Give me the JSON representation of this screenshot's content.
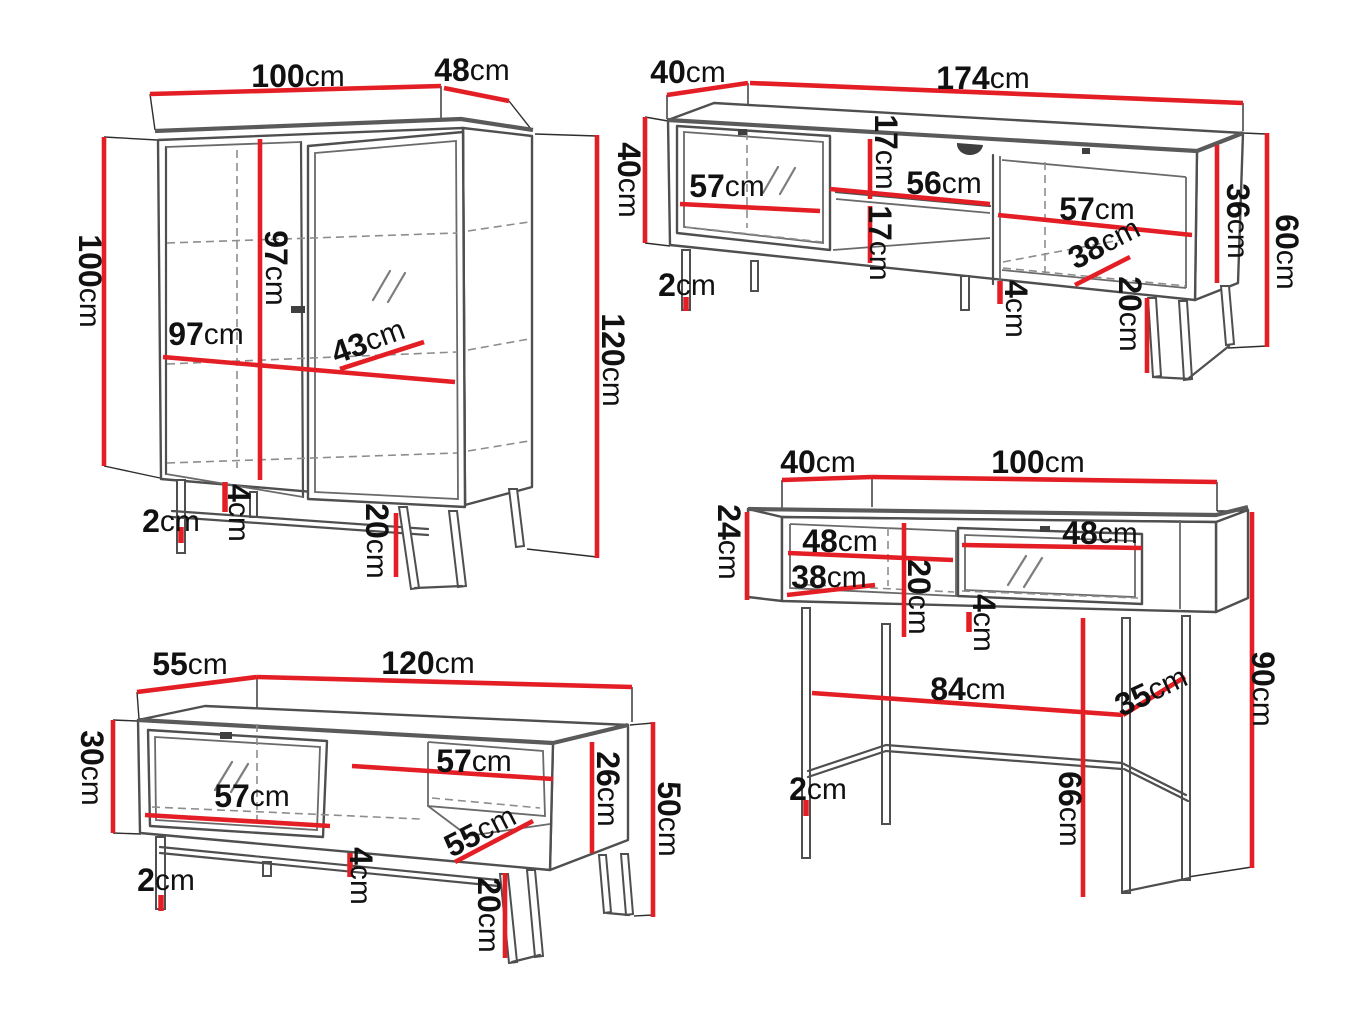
{
  "title": "furniture-dimensions-diagram",
  "colors": {
    "dimension_line": "#e41e25",
    "outline": "#4f4f4f",
    "hidden_line": "#8d8d8d",
    "text": "#111111",
    "background": "#ffffff"
  },
  "unit": "cm",
  "pieces": [
    {
      "name": "display-cabinet",
      "dims": [
        {
          "k": "top-width",
          "v": "100",
          "u": "cm"
        },
        {
          "k": "top-depth",
          "v": "48",
          "u": "cm"
        },
        {
          "k": "left-height",
          "v": "100",
          "u": "cm"
        },
        {
          "k": "interior-height",
          "v": "97",
          "u": "cm"
        },
        {
          "k": "interior-width",
          "v": "97",
          "u": "cm"
        },
        {
          "k": "shelf-width",
          "v": "43",
          "u": "cm"
        },
        {
          "k": "total-height",
          "v": "120",
          "u": "cm"
        },
        {
          "k": "base-gap",
          "v": "4",
          "u": "cm"
        },
        {
          "k": "leg-thickness",
          "v": "2",
          "u": "cm"
        },
        {
          "k": "leg-height",
          "v": "20",
          "u": "cm"
        }
      ]
    },
    {
      "name": "tv-stand",
      "dims": [
        {
          "k": "top-depth",
          "v": "40",
          "u": "cm"
        },
        {
          "k": "width",
          "v": "174",
          "u": "cm"
        },
        {
          "k": "left-height",
          "v": "40",
          "u": "cm"
        },
        {
          "k": "door-width",
          "v": "57",
          "u": "cm"
        },
        {
          "k": "shelf-gap-top",
          "v": "17",
          "u": "cm"
        },
        {
          "k": "shelf-width",
          "v": "56",
          "u": "cm"
        },
        {
          "k": "shelf-gap-bottom",
          "v": "17",
          "u": "cm"
        },
        {
          "k": "right-opening-width",
          "v": "57",
          "u": "cm"
        },
        {
          "k": "right-opening-depth",
          "v": "38",
          "u": "cm"
        },
        {
          "k": "side-height",
          "v": "36",
          "u": "cm"
        },
        {
          "k": "total-height",
          "v": "60",
          "u": "cm"
        },
        {
          "k": "leg-thickness",
          "v": "2",
          "u": "cm"
        },
        {
          "k": "base-gap",
          "v": "4",
          "u": "cm"
        },
        {
          "k": "leg-height",
          "v": "20",
          "u": "cm"
        }
      ]
    },
    {
      "name": "coffee-table",
      "dims": [
        {
          "k": "top-depth",
          "v": "55",
          "u": "cm"
        },
        {
          "k": "width",
          "v": "120",
          "u": "cm"
        },
        {
          "k": "left-height",
          "v": "30",
          "u": "cm"
        },
        {
          "k": "door-width",
          "v": "57",
          "u": "cm"
        },
        {
          "k": "shelf-width",
          "v": "57",
          "u": "cm"
        },
        {
          "k": "inner-height",
          "v": "26",
          "u": "cm"
        },
        {
          "k": "total-height",
          "v": "50",
          "u": "cm"
        },
        {
          "k": "shelf-depth",
          "v": "55",
          "u": "cm"
        },
        {
          "k": "base-gap",
          "v": "4",
          "u": "cm"
        },
        {
          "k": "leg-thickness",
          "v": "2",
          "u": "cm"
        },
        {
          "k": "leg-height",
          "v": "20",
          "u": "cm"
        }
      ]
    },
    {
      "name": "console-desk",
      "dims": [
        {
          "k": "top-depth",
          "v": "40",
          "u": "cm"
        },
        {
          "k": "top-width",
          "v": "100",
          "u": "cm"
        },
        {
          "k": "body-height",
          "v": "24",
          "u": "cm"
        },
        {
          "k": "opening-width",
          "v": "48",
          "u": "cm"
        },
        {
          "k": "opening-depth",
          "v": "38",
          "u": "cm"
        },
        {
          "k": "inner-height",
          "v": "20",
          "u": "cm"
        },
        {
          "k": "drawer-width",
          "v": "48",
          "u": "cm"
        },
        {
          "k": "base-gap",
          "v": "4",
          "u": "cm"
        },
        {
          "k": "stretcher-width",
          "v": "84",
          "u": "cm"
        },
        {
          "k": "stretcher-depth",
          "v": "35",
          "u": "cm"
        },
        {
          "k": "total-height",
          "v": "90",
          "u": "cm"
        },
        {
          "k": "clearance-height",
          "v": "66",
          "u": "cm"
        },
        {
          "k": "leg-thickness",
          "v": "2",
          "u": "cm"
        }
      ]
    }
  ]
}
